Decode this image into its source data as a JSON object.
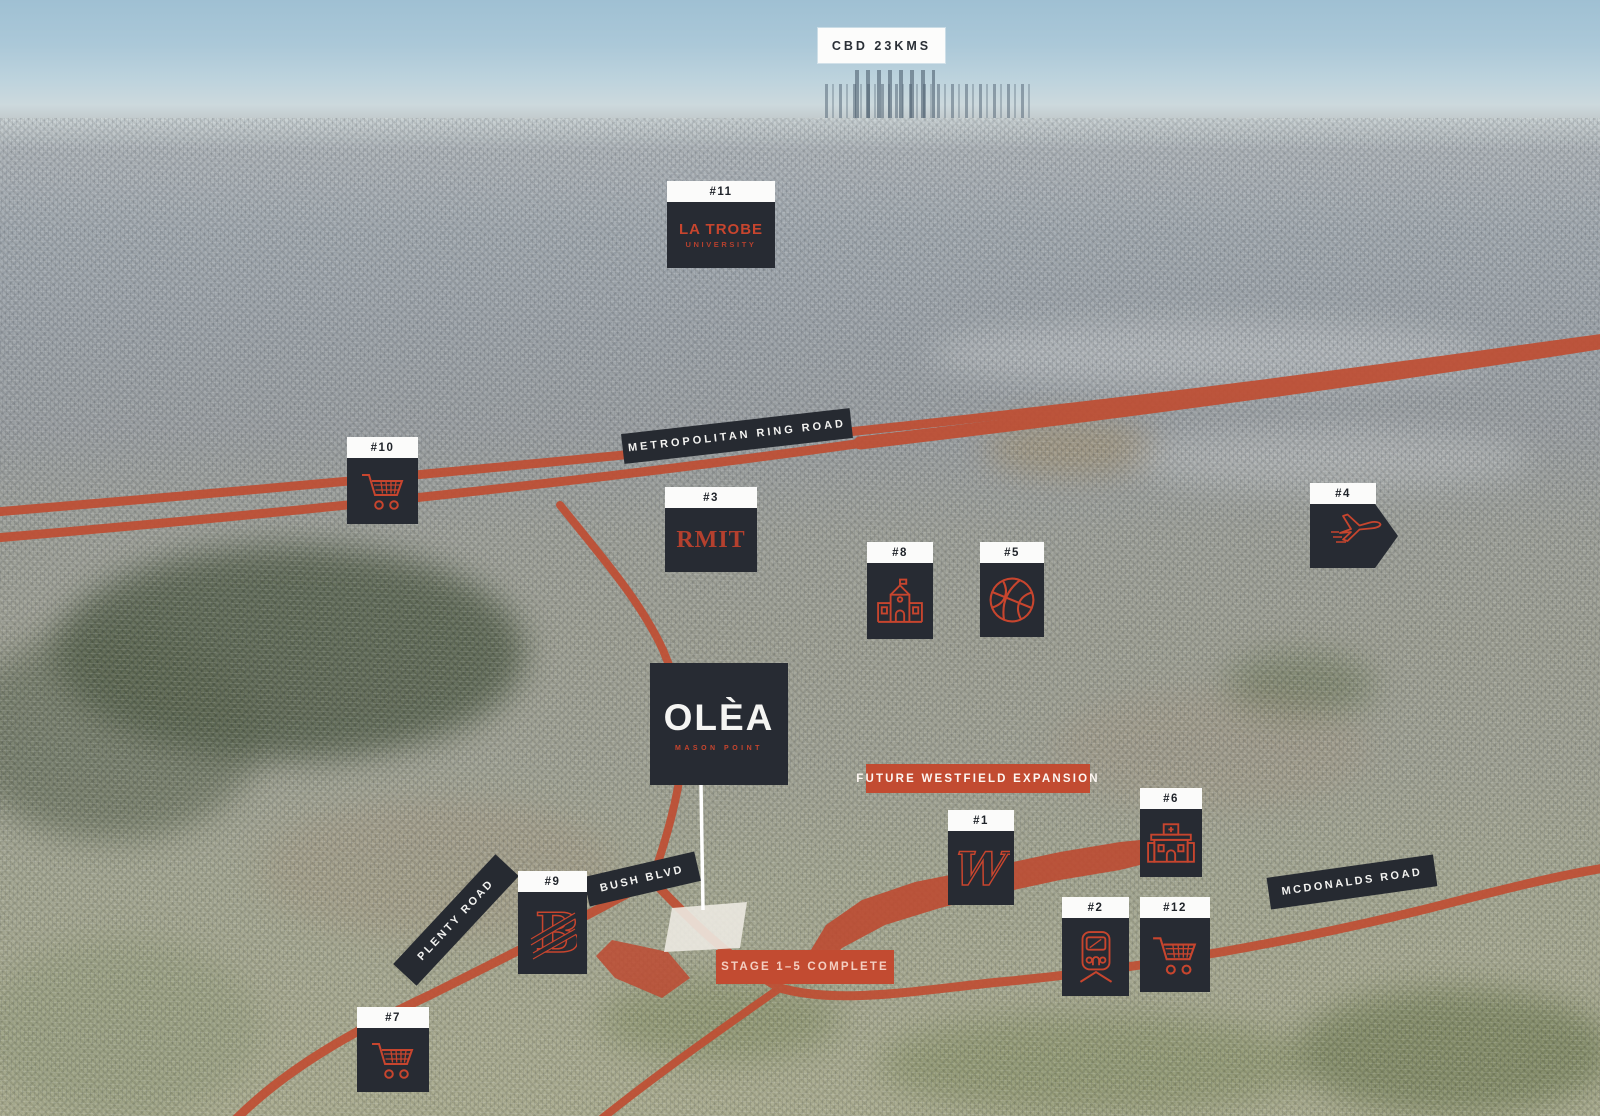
{
  "colors": {
    "accent_red": "#c7452e",
    "marker_dark": "#272b33",
    "banner_red": "#c24b31",
    "road_red": "#bf4e33"
  },
  "cbd_badge": {
    "label": "CBD 23KMS"
  },
  "road_banners": {
    "ring_road": "METROPOLITAN RING ROAD",
    "bush_blvd": "BUSH BLVD",
    "plenty_road": "PLENTY ROAD",
    "mcdonalds_road": "MCDONALDS ROAD"
  },
  "overlays": {
    "westfield_expansion": "FUTURE WESTFIELD EXPANSION",
    "stage_complete": "STAGE 1–5 COMPLETE"
  },
  "project": {
    "name": "OLÈA",
    "subtitle": "MASON POINT"
  },
  "markers": [
    {
      "id": "#1",
      "place_icon": "westfield-logo-icon"
    },
    {
      "id": "#2",
      "place_icon": "train-icon"
    },
    {
      "id": "#3",
      "place_icon": "rmit-logo-text",
      "text": "RMIT"
    },
    {
      "id": "#4",
      "place_icon": "airplane-icon"
    },
    {
      "id": "#5",
      "place_icon": "basketball-icon"
    },
    {
      "id": "#6",
      "place_icon": "hospital-icon"
    },
    {
      "id": "#7",
      "place_icon": "shopping-cart-icon"
    },
    {
      "id": "#8",
      "place_icon": "school-icon"
    },
    {
      "id": "#9",
      "place_icon": "letter-b-logo-icon"
    },
    {
      "id": "#10",
      "place_icon": "shopping-cart-icon"
    },
    {
      "id": "#11",
      "place_icon": "latrobe-logo-text",
      "text": "LA TROBE",
      "subtext": "UNIVERSITY"
    },
    {
      "id": "#12",
      "place_icon": "shopping-cart-icon"
    }
  ]
}
